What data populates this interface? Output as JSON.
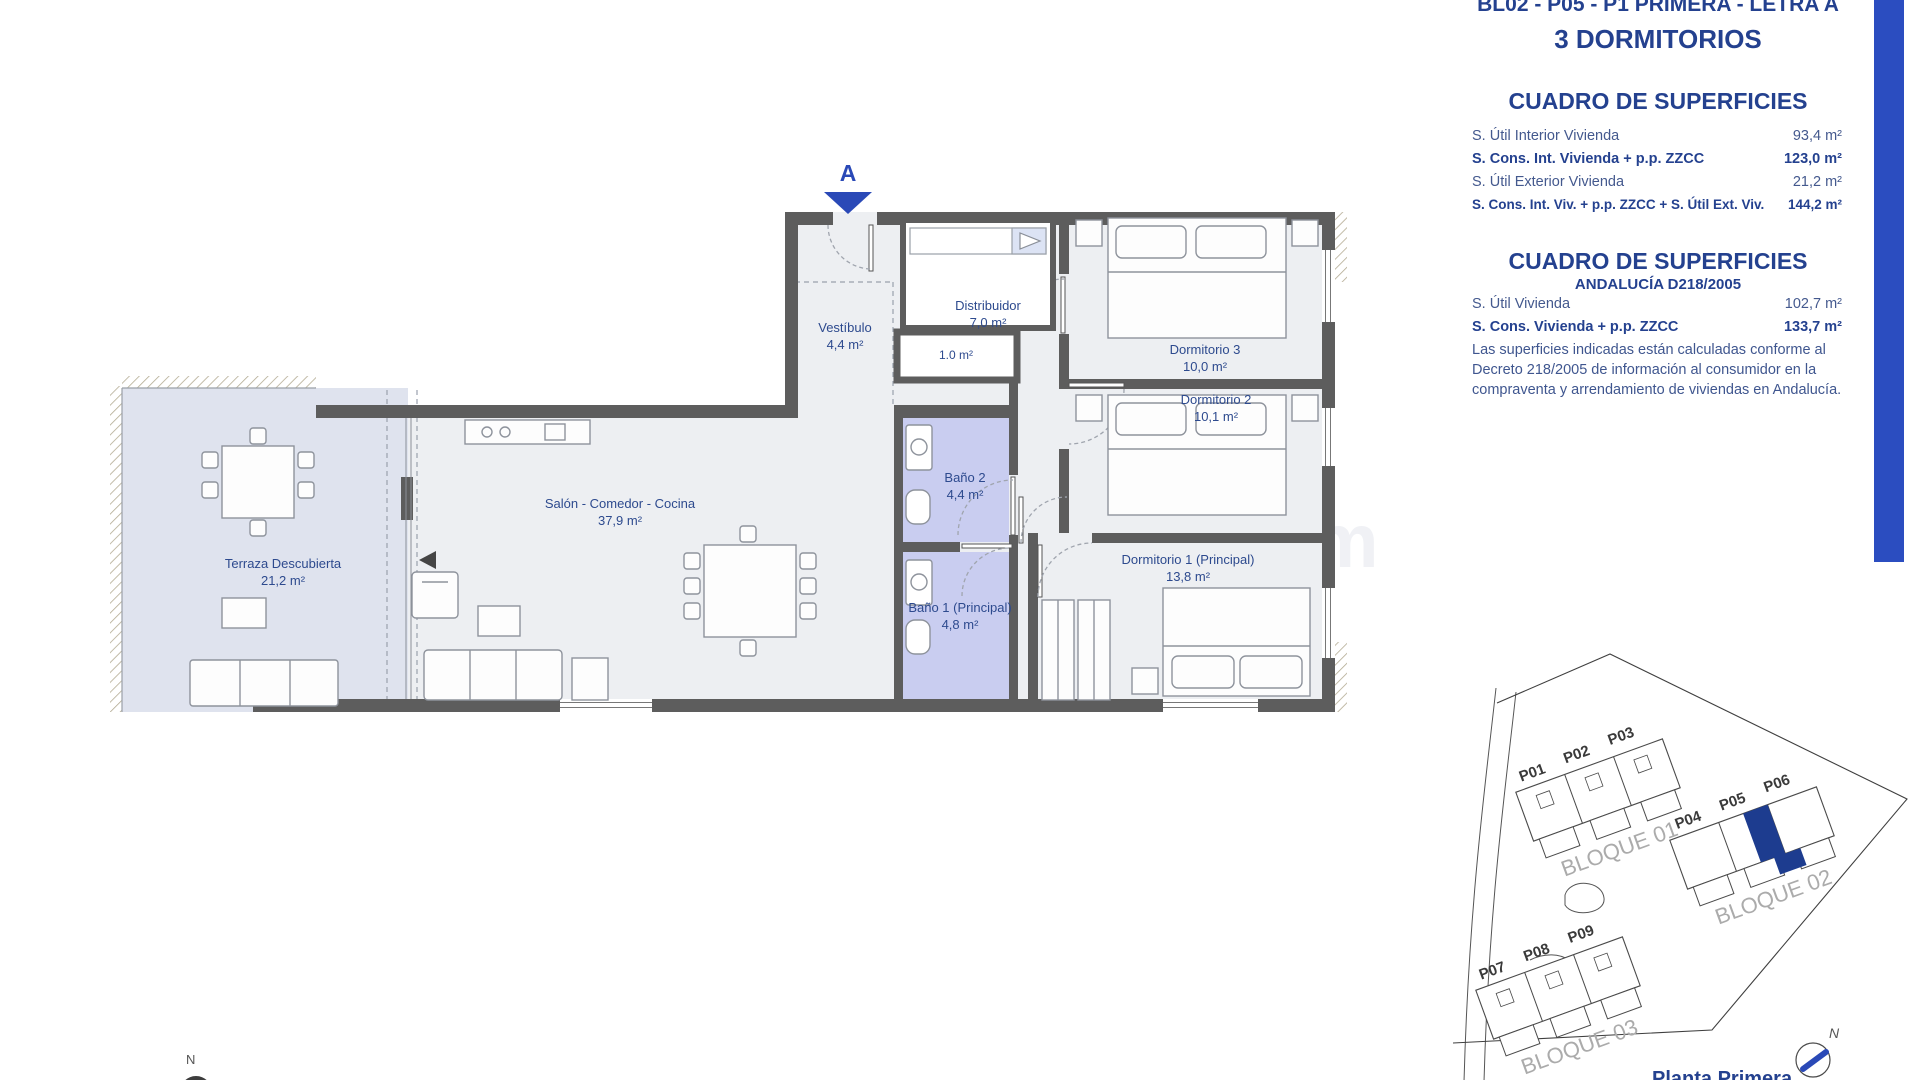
{
  "accent": "#2a49b7",
  "navy": "#24418f",
  "watermark": "Spain1.com",
  "header": {
    "title": "BL02 - P05 - P1 PRIMERA - LETRA A",
    "subtitle": "3 DORMITORIOS"
  },
  "surfaces_table": {
    "heading": "CUADRO DE SUPERFICIES",
    "rows": [
      {
        "label": "S. Útil Interior Vivienda",
        "value": "93,4 m²"
      },
      {
        "label": "S. Cons. Int. Vivienda + p.p. ZZCC",
        "value": "123,0 m²"
      },
      {
        "label": "S. Útil Exterior Vivienda",
        "value": "21,2 m²"
      },
      {
        "label": "S. Cons. Int. Viv. + p.p. ZZCC + S. Útil Ext. Viv.",
        "value": "144,2 m²"
      }
    ]
  },
  "surfaces_table2": {
    "heading": "CUADRO DE SUPERFICIES",
    "subheading": "ANDALUCÍA D218/2005",
    "rows": [
      {
        "label": "S. Útil Vivienda",
        "value": "102,7 m²"
      },
      {
        "label": "S. Cons. Vivienda + p.p. ZZCC",
        "value": "133,7 m²"
      }
    ],
    "note": "Las superficies indicadas están calculadas conforme al Decreto 218/2005 de información al consumidor en la compraventa y arrendamiento de viviendas en Andalucía."
  },
  "floorplan": {
    "entrance_label": "A",
    "north_label": "N",
    "rooms": {
      "vestibulo": {
        "name": "Vestíbulo",
        "area": "4,4 m²"
      },
      "distribuidor": {
        "name": "Distribuidor",
        "area": "7,0 m²"
      },
      "closet": {
        "area": "1.0 m²"
      },
      "dormitorio3": {
        "name": "Dormitorio 3",
        "area": "10,0 m²"
      },
      "dormitorio2": {
        "name": "Dormitorio 2",
        "area": "10,1 m²"
      },
      "salon": {
        "name": "Salón - Comedor - Cocina",
        "area": "37,9 m²"
      },
      "bano2": {
        "name": "Baño 2",
        "area": "4,4 m²"
      },
      "terraza": {
        "name": "Terraza Descubierta",
        "area": "21,2 m²"
      },
      "bano1": {
        "name": "Baño 1 (Principal)",
        "area": "4,8 m²"
      },
      "dormitorio1": {
        "name": "Dormitorio 1 (Principal)",
        "area": "13,8 m²"
      }
    }
  },
  "siteplan": {
    "blocks": [
      "BLOQUE 01",
      "BLOQUE 02",
      "BLOQUE 03"
    ],
    "units": [
      "P01",
      "P02",
      "P03",
      "P04",
      "P05",
      "P06",
      "P07",
      "P08",
      "P09"
    ],
    "compass_label": "N",
    "caption": "Planta Primera"
  }
}
